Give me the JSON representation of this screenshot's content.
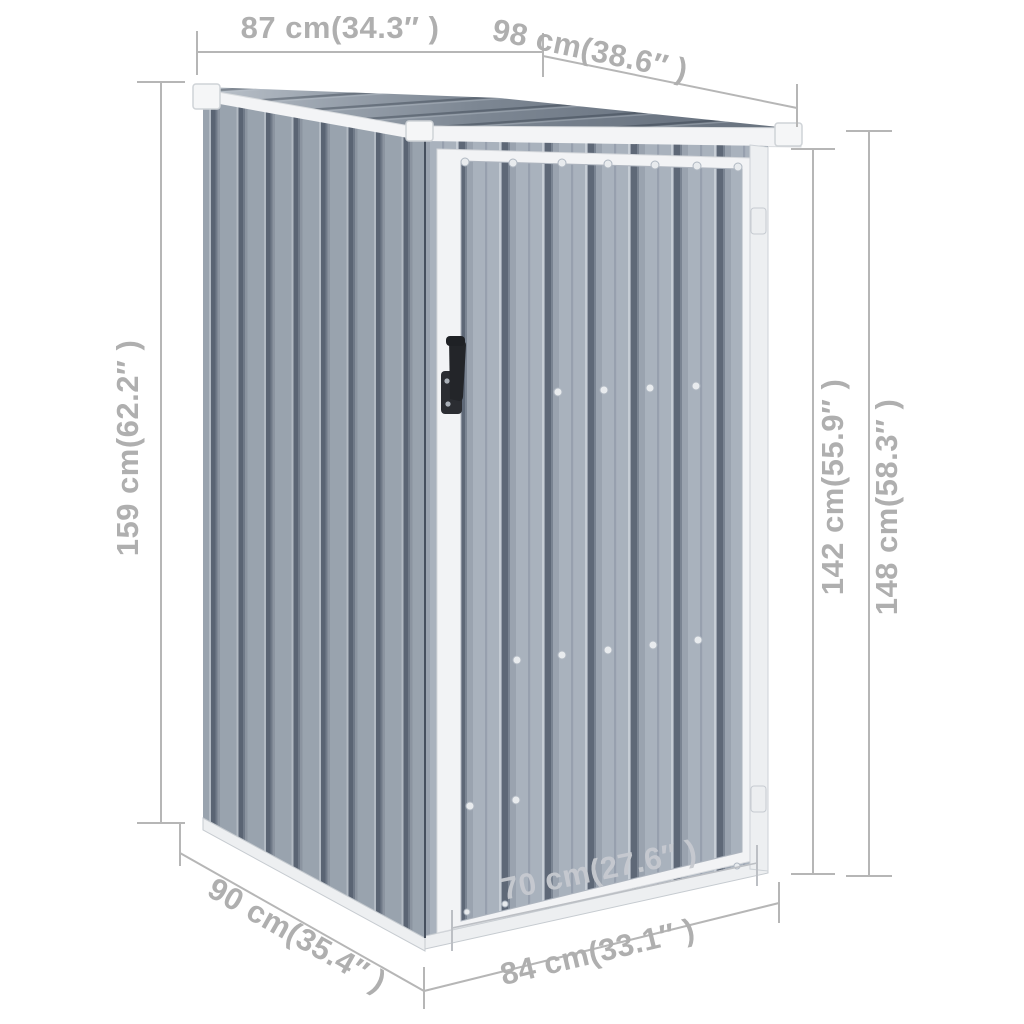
{
  "diagram": {
    "subject": "metal garden storage shed with single door, pent roof, dimension annotations",
    "background": "#ffffff",
    "annotation_color": "#b6b6b6",
    "dimensions": {
      "top_side_width": {
        "label": "87 cm(34.3″ )",
        "cm": 87,
        "inch": 34.3
      },
      "top_front_width": {
        "label": "98 cm(38.6″ )",
        "cm": 98,
        "inch": 38.6
      },
      "height_left": {
        "label": "159 cm(62.2″ )",
        "cm": 159,
        "inch": 62.2
      },
      "height_right_wall": {
        "label": "142 cm(55.9″ )",
        "cm": 142,
        "inch": 55.9
      },
      "height_right_total": {
        "label": "148 cm(58.3″ )",
        "cm": 148,
        "inch": 58.3
      },
      "base_side_depth": {
        "label": "90 cm(35.4″ )",
        "cm": 90,
        "inch": 35.4
      },
      "door_width": {
        "label": "70 cm(27.6″ )",
        "cm": 70,
        "inch": 27.6
      },
      "base_front_width": {
        "label": "84 cm(33.1″ )",
        "cm": 84,
        "inch": 33.1
      }
    },
    "colors": {
      "wall_panel": "#99a3ae",
      "wall_groove": "#5a6473",
      "door_panel": "#a9b2bd",
      "door_groove": "#5e6877",
      "roof_dark": "#69737f",
      "roof_light": "#bcc3cb",
      "trim_white": "#f2f3f5",
      "handle_black": "#26282c"
    }
  }
}
